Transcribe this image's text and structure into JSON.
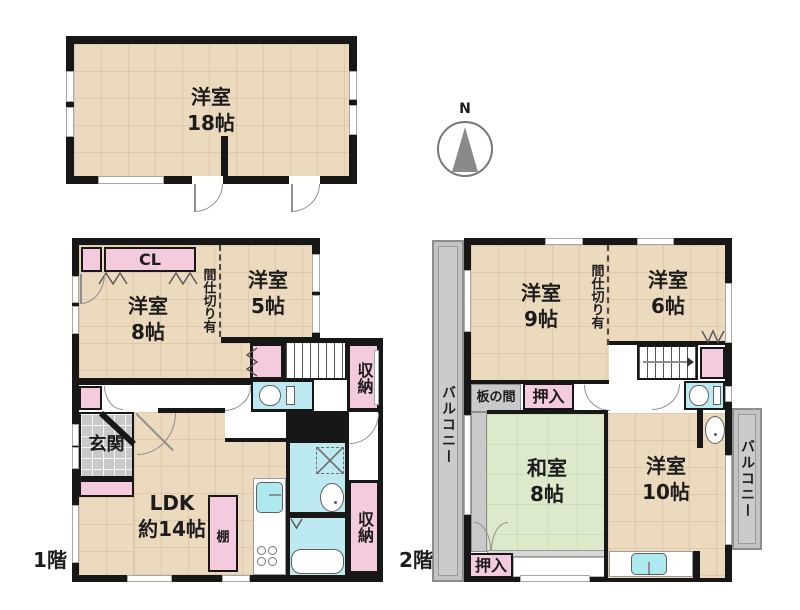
{
  "compass": {
    "north_label": "N"
  },
  "annex": {
    "room": {
      "name": "洋室",
      "size": "18帖"
    }
  },
  "floor1": {
    "floor_label": "1階",
    "closet_cl": "CL",
    "west8": {
      "name": "洋室",
      "size": "8帖"
    },
    "partition_note": "間仕切り有",
    "west5": {
      "name": "洋室",
      "size": "5帖"
    },
    "storage_upper": "収納",
    "genkan": "玄関",
    "ldk": {
      "name": "LDK",
      "size": "約14帖"
    },
    "shelf": "棚",
    "storage_lower": "収納"
  },
  "floor2": {
    "floor_label": "2階",
    "balcony_left": "バルコニー",
    "west9": {
      "name": "洋室",
      "size": "9帖"
    },
    "partition_note": "間仕切り有",
    "west6": {
      "name": "洋室",
      "size": "6帖"
    },
    "itanoma": "板の間",
    "oshiire_upper": "押入",
    "washitsu": {
      "name": "和室",
      "size": "8帖"
    },
    "west10": {
      "name": "洋室",
      "size": "10帖"
    },
    "balcony_right": "バルコニー",
    "oshiire_lower": "押入"
  },
  "colors": {
    "wall": "#171717",
    "wood_floor": "#ecdabf",
    "closet_pink": "#f3cade",
    "wet_area_cyan": "#bceaf0",
    "tatami_green": "#dde9cb",
    "tile_gray": "#c9c9c9",
    "balcony_gray": "#cbcbcb",
    "compass_gray": "#8a8a8a"
  }
}
